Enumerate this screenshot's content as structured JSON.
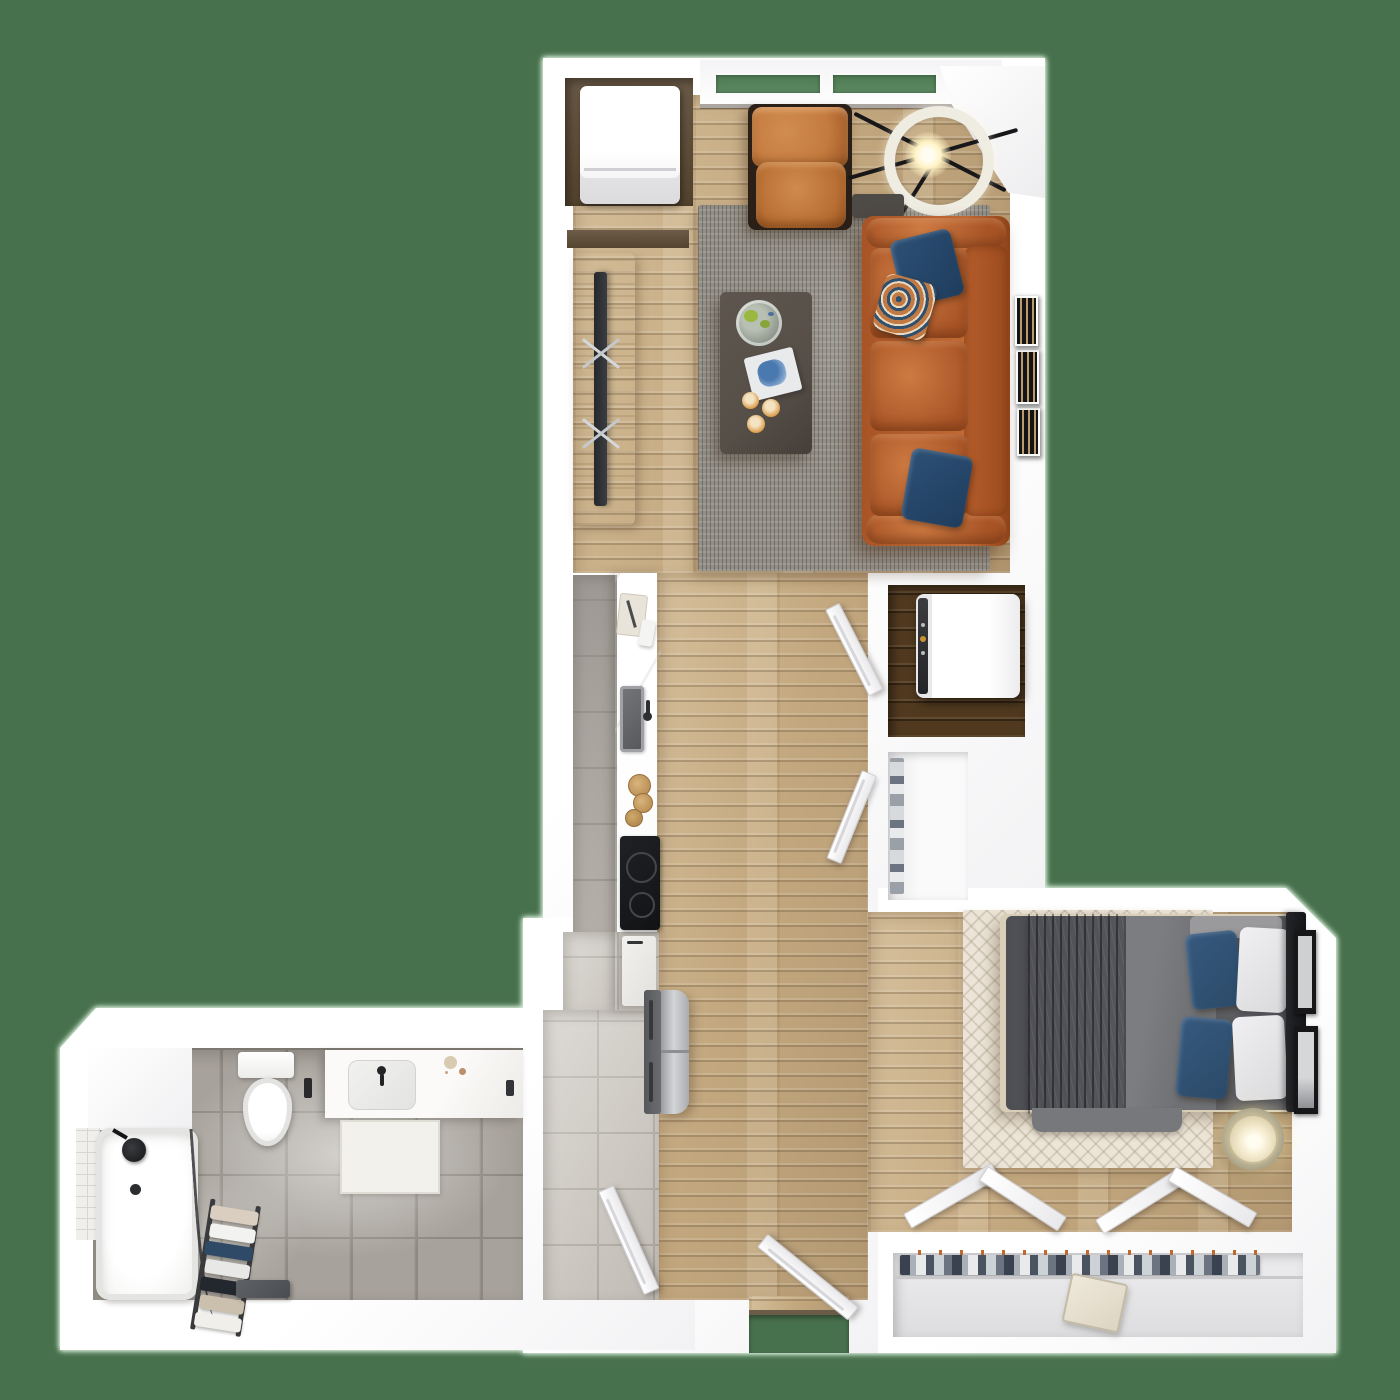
{
  "scene": {
    "type": "3d-rendered-floor-plan",
    "view": "top-down",
    "description": "Studio apartment 3D floor plan render on green background",
    "visible_text": "none",
    "rooms": [
      {
        "name": "living-room",
        "floor": "light-oak-wood",
        "items": [
          "storage-closet-with-stacked-washer",
          "tv-console",
          "tv",
          "area-rug",
          "lounge-chair",
          "ring-pendant-light",
          "leather-sofa",
          "coffee-table",
          "wall-art-trio",
          "windows"
        ]
      },
      {
        "name": "kitchen",
        "floor": "tile-strip",
        "items": [
          "counter-run",
          "sink",
          "cutting-boards",
          "cooktop",
          "cabinet",
          "refrigerator"
        ]
      },
      {
        "name": "hallway",
        "floor": "light-oak-wood",
        "items": [
          "laundry-closet-door",
          "linen-closet-door"
        ]
      },
      {
        "name": "laundry-closet",
        "floor": "dark-walnut",
        "items": [
          "washer-dryer-unit"
        ]
      },
      {
        "name": "linen-closet",
        "floor": "white",
        "items": [
          "shelving"
        ]
      },
      {
        "name": "bedroom",
        "floor": "light-oak-wood",
        "items": [
          "bed",
          "navy-pillows",
          "white-pillows",
          "throw-blanket",
          "headboard",
          "chevron-rug",
          "glowing-table-lamp",
          "wall-frames",
          "bifold-closet-doors"
        ]
      },
      {
        "name": "wardrobe-closet",
        "floor": "white",
        "items": [
          "hanging-clothes",
          "shelf",
          "storage-basket"
        ]
      },
      {
        "name": "bathroom",
        "floor": "gray-tile",
        "items": [
          "toilet",
          "toilet-paper-holder",
          "vanity-sink",
          "diamond-bath-mat",
          "bathtub-shower",
          "shower-head",
          "towel-ladder",
          "bench"
        ]
      },
      {
        "name": "entry",
        "floor": "large-format-tile",
        "items": [
          "entry-door",
          "bathroom-door"
        ]
      }
    ],
    "counts": {
      "windows": 2,
      "sofa_seat_cushions": 3,
      "throw_pillows_sofa": 3,
      "bed_pillows": 5,
      "bifold_closet_panels": 4,
      "wall_art_living": 3,
      "wall_frames_bedroom": 2,
      "hall_closet_doors": 2
    }
  },
  "palette": {
    "bg": "#47704C",
    "rim": "#D7EED9",
    "wall": "#FFFFFF",
    "wood": "#C3A87F",
    "tileentry": "#CCC7BF",
    "tilebath": "#A7A29B",
    "wdfloor": "#50391F",
    "rug": "#928E86",
    "chevron": "#ECE4D6",
    "leather": "#A85426",
    "leatherlite": "#CD7A42",
    "navy": "#1F3D5E",
    "rust": "#C47A3E",
    "tabletop": "#564F48",
    "duvet": "#55565B",
    "throw": "#303236",
    "sheet": "#6E7074",
    "glass": "#4D7A52",
    "lampglow": "#FFF3C4",
    "orangehanger": "#C06A30"
  }
}
